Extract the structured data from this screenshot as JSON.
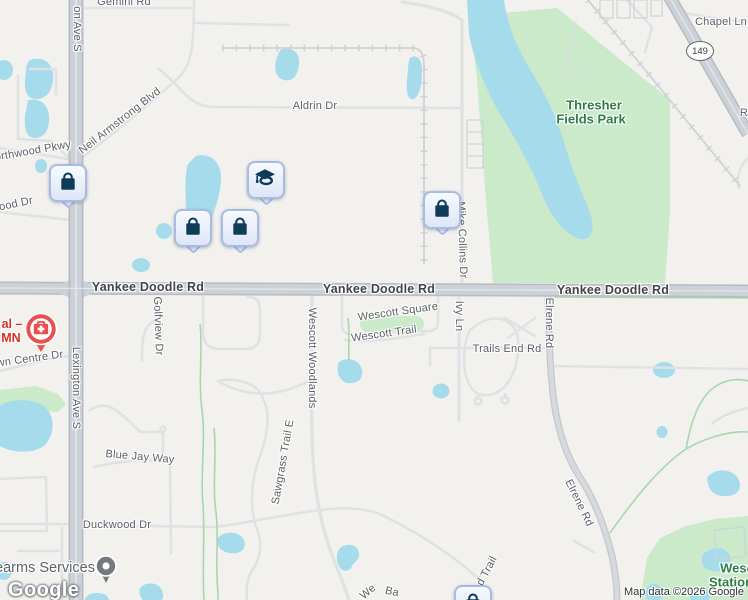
{
  "attribution": {
    "logo_text": "Google",
    "map_data_text": "Map data ©2026 Google"
  },
  "shield": {
    "route": "149"
  },
  "colors": {
    "background": "#f2f1ee",
    "water": "#a6dbec",
    "park": "#caeac9",
    "road_major_fill": "#ccd1d7",
    "road_major_casing": "#b6bcc3",
    "road_minor": "#dfe2e5",
    "trail_green": "#a9d6ab",
    "marker_navy": "#0e3c57",
    "marker_pin_bg": "#e3eafa",
    "marker_pin_border": "#a7bce4",
    "hospital_red": "#e8504f",
    "poi_dot_gray": "#75797e",
    "park_label_green": "#2e7d46",
    "poi_red_text": "#d93025"
  },
  "labels": [
    {
      "text": "Gemini Rd",
      "x": 124,
      "y": 2,
      "rot": 0,
      "kind": "road"
    },
    {
      "text": "on Ave S",
      "x": 77,
      "y": 29,
      "rot": 90,
      "kind": "road"
    },
    {
      "text": "Neil Armstrong Blvd",
      "x": 120,
      "y": 121,
      "rot": -38,
      "kind": "road"
    },
    {
      "text": "orthwood Pkwy",
      "x": 33,
      "y": 151,
      "rot": -10,
      "kind": "road"
    },
    {
      "text": "ood Dr",
      "x": 16,
      "y": 204,
      "rot": -12,
      "kind": "road"
    },
    {
      "text": "Aldrin Dr",
      "x": 315,
      "y": 106,
      "rot": 0,
      "kind": "road"
    },
    {
      "text": "Chapel Ln",
      "x": 721,
      "y": 22,
      "rot": 0,
      "kind": "road"
    },
    {
      "text": "R",
      "x": 744,
      "y": 113,
      "rot": 0,
      "kind": "road"
    },
    {
      "text": "Yankee Doodle Rd",
      "x": 148,
      "y": 287,
      "rot": 0,
      "kind": "road-major"
    },
    {
      "text": "Yankee Doodle Rd",
      "x": 379,
      "y": 289,
      "rot": 0,
      "kind": "road-major"
    },
    {
      "text": "Yankee Doodle Rd",
      "x": 613,
      "y": 290,
      "rot": 0,
      "kind": "road-major"
    },
    {
      "text": "Wescott Square",
      "x": 398,
      "y": 312,
      "rot": -8,
      "kind": "road"
    },
    {
      "text": "Wescott Trail",
      "x": 384,
      "y": 334,
      "rot": -8,
      "kind": "road"
    },
    {
      "text": "Golfview Dr",
      "x": 158,
      "y": 326,
      "rot": 88,
      "kind": "road"
    },
    {
      "text": "Wescott Woodlands",
      "x": 312,
      "y": 358,
      "rot": 90,
      "kind": "road"
    },
    {
      "text": "Ivy Ln",
      "x": 459,
      "y": 316,
      "rot": 90,
      "kind": "road"
    },
    {
      "text": "Mike Collins Dr",
      "x": 462,
      "y": 240,
      "rot": 88,
      "kind": "road"
    },
    {
      "text": "Elrene Rd",
      "x": 549,
      "y": 323,
      "rot": 90,
      "kind": "road"
    },
    {
      "text": "Elrene Rd",
      "x": 579,
      "y": 503,
      "rot": 64,
      "kind": "road"
    },
    {
      "text": "Trails End Rd",
      "x": 507,
      "y": 349,
      "rot": 0,
      "kind": "road"
    },
    {
      "text": "Lexington Ave S",
      "x": 76,
      "y": 388,
      "rot": 90,
      "kind": "road"
    },
    {
      "text": "Blue Jay Way",
      "x": 140,
      "y": 457,
      "rot": 5,
      "kind": "road"
    },
    {
      "text": "Duckwood Dr",
      "x": 117,
      "y": 525,
      "rot": 0,
      "kind": "road"
    },
    {
      "text": "wn Centre Dr",
      "x": 30,
      "y": 359,
      "rot": -8,
      "kind": "road"
    },
    {
      "text": "Sawgrass Trail E",
      "x": 283,
      "y": 462,
      "rot": -80,
      "kind": "road"
    },
    {
      "text": "d Trail",
      "x": 487,
      "y": 571,
      "rot": -62,
      "kind": "road"
    },
    {
      "text": "We",
      "x": 368,
      "y": 592,
      "rot": -40,
      "kind": "road"
    },
    {
      "text": "Ba",
      "x": 392,
      "y": 592,
      "rot": 12,
      "kind": "road"
    },
    {
      "text": "Thresher",
      "x": 594,
      "y": 105,
      "rot": 0,
      "kind": "park"
    },
    {
      "text": "Fields Park",
      "x": 591,
      "y": 119,
      "rot": 0,
      "kind": "park"
    },
    {
      "text": "Wesc",
      "x": 737,
      "y": 568,
      "rot": 0,
      "kind": "park"
    },
    {
      "text": "Station",
      "x": 731,
      "y": 582,
      "rot": 0,
      "kind": "park"
    },
    {
      "text": "al –",
      "x": 12,
      "y": 324,
      "rot": 0,
      "kind": "poi-red"
    },
    {
      "text": "MN",
      "x": 11,
      "y": 338,
      "rot": 0,
      "kind": "poi-red"
    },
    {
      "text": "earms Services",
      "x": 45,
      "y": 568,
      "rot": 0,
      "kind": "poi"
    }
  ],
  "markers": [
    {
      "type": "shopping-bag",
      "x": 49,
      "y": 164
    },
    {
      "type": "graduation-cap",
      "x": 247,
      "y": 161
    },
    {
      "type": "shopping-bag",
      "x": 174,
      "y": 209
    },
    {
      "type": "shopping-bag",
      "x": 221,
      "y": 209
    },
    {
      "type": "shopping-bag",
      "x": 423,
      "y": 191
    },
    {
      "type": "shopping-bag",
      "x": 454,
      "y": 585
    },
    {
      "type": "hospital",
      "x": 41,
      "y": 329
    },
    {
      "type": "poi-dot",
      "x": 106,
      "y": 566
    }
  ]
}
